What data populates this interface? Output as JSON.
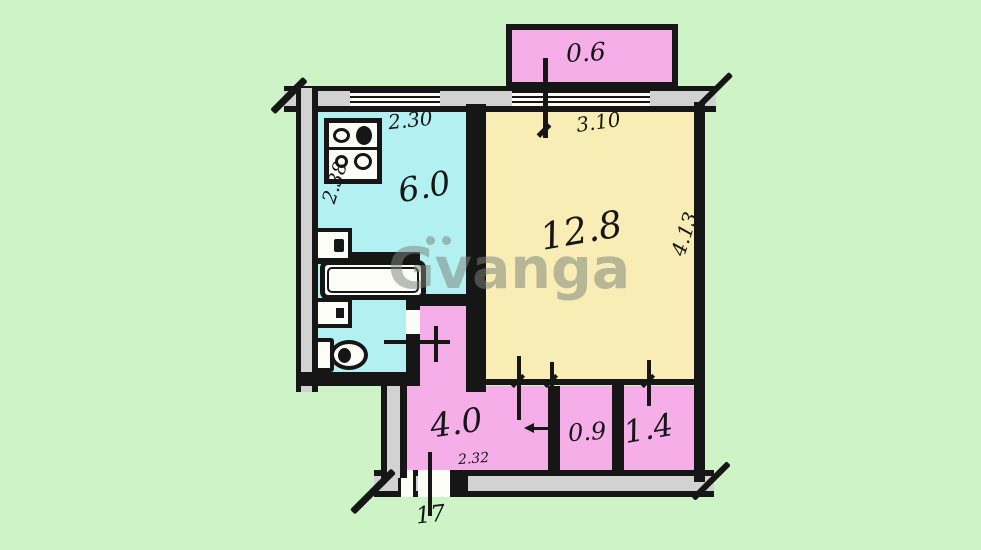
{
  "watermark": {
    "text": "Gvanga"
  },
  "labels": {
    "balcony_area": "0.6",
    "kitchen_width": "2.30",
    "kitchen_area": "6.0",
    "kitchen_depth": "2.38",
    "room_width": "3.10",
    "room_area": "12.8",
    "room_depth": "4.13",
    "hall_area": "4.0",
    "hall_width": "2.32",
    "entry_width": "17",
    "wc_area": "0.9",
    "closet_area": "1.4"
  },
  "icons": [
    "stove-icon",
    "kitchen-sink-icon",
    "bathtub-icon",
    "washbasin-icon",
    "toilet-icon"
  ],
  "colors": {
    "background": "#cdf3c6",
    "balcony_fill": "#f5aee8",
    "kitchen_fill": "#b2f0f2",
    "room_fill": "#f8edb4",
    "hall_fill": "#f5aee8",
    "wall_gray": "#d2d2d2",
    "line_black": "#161616",
    "watermark_gray": "#7a847a"
  }
}
